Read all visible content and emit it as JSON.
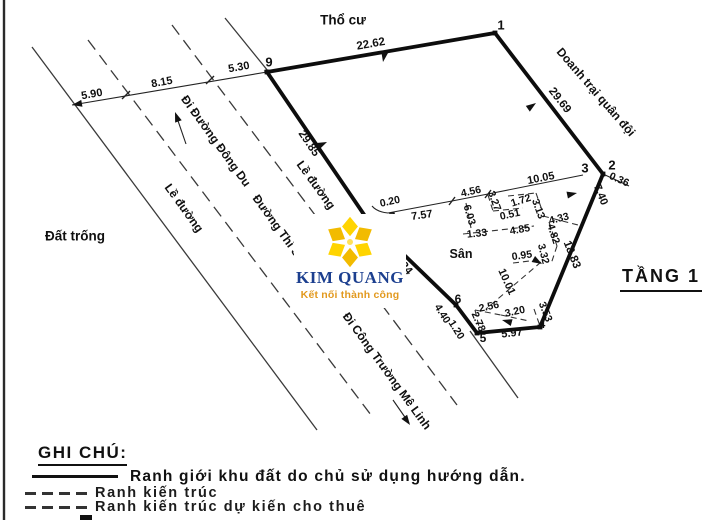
{
  "colors": {
    "ink": "#111111",
    "logo_navy": "#1c3f8f",
    "logo_orange": "#e2991e",
    "logo_yellow": "#ffd400",
    "logo_yellow_dark": "#f2bb00"
  },
  "logo": {
    "name": "KIM QUANG",
    "tagline": "Kết nối thành công"
  },
  "floor_tag": "TẦNG 1",
  "legend": {
    "title": "GHI CHÚ:",
    "items": [
      {
        "style": "solid-bold",
        "label": "Ranh giới khu đất do chủ sử dụng hướng dẫn."
      },
      {
        "style": "dashed",
        "label": "Ranh kiến trúc"
      },
      {
        "style": "dashed",
        "label": "Ranh kiến trúc dự kiến cho thuê"
      },
      {
        "style": "dashed-partial",
        "label": ""
      }
    ]
  },
  "diagram": {
    "boundary_points": "267,72 495,33 603,174 540,327 477,333 456,305 367,219",
    "lines": [
      {
        "name": "page-border-left",
        "cls": "border-line",
        "x1": 4,
        "y1": 0,
        "x2": 4,
        "y2": 520
      },
      {
        "name": "road-line-outer-left",
        "cls": "road-solid",
        "x1": 32,
        "y1": 47,
        "x2": 317,
        "y2": 430
      },
      {
        "name": "road-line-dash-left",
        "cls": "road-dash",
        "x1": 88,
        "y1": 40,
        "x2": 374,
        "y2": 419
      },
      {
        "name": "road-line-dash-right-upper",
        "cls": "road-dash",
        "x1": 172,
        "y1": 25,
        "x2": 315,
        "y2": 215
      },
      {
        "name": "road-line-dash-right-lower",
        "cls": "road-dash",
        "x1": 382,
        "y1": 305,
        "x2": 457,
        "y2": 405
      },
      {
        "name": "road-line-outer-right-upper",
        "cls": "road-solid",
        "x1": 225,
        "y1": 18,
        "x2": 268,
        "y2": 71
      },
      {
        "name": "road-line-outer-right-lower",
        "cls": "road-solid",
        "x1": 470,
        "y1": 331,
        "x2": 518,
        "y2": 398
      },
      {
        "name": "dim-line-left",
        "cls": "dim",
        "x1": 72,
        "y1": 105,
        "x2": 267,
        "y2": 72
      },
      {
        "name": "leader-0-36",
        "cls": "dim",
        "x1": 603,
        "y1": 174,
        "x2": 629,
        "y2": 186
      },
      {
        "name": "dir-dong-du-shaft",
        "cls": "dim",
        "x1": 186,
        "y1": 144,
        "x2": 176,
        "y2": 115
      },
      {
        "name": "dir-me-linh-shaft",
        "cls": "dim",
        "x1": 393,
        "y1": 400,
        "x2": 409,
        "y2": 423
      },
      {
        "name": "tick-dim-left-1",
        "cls": "tick",
        "x1": 122,
        "y1": 99,
        "x2": 130,
        "y2": 91
      },
      {
        "name": "tick-dim-left-2",
        "cls": "tick",
        "x1": 206,
        "y1": 84,
        "x2": 214,
        "y2": 76
      },
      {
        "name": "tick-dim-top-1",
        "cls": "tick",
        "x1": 449,
        "y1": 205,
        "x2": 455,
        "y2": 197
      },
      {
        "name": "tick-dim-top-2",
        "cls": "tick",
        "x1": 485,
        "y1": 198,
        "x2": 491,
        "y2": 190
      },
      {
        "name": "inner-wall-6-03",
        "cls": "inner-dash",
        "x1": 466,
        "y1": 203,
        "x2": 471,
        "y2": 228
      },
      {
        "name": "inner-wall-1-33",
        "cls": "inner-dash",
        "x1": 463,
        "y1": 234,
        "x2": 482,
        "y2": 232
      },
      {
        "name": "inner-wall-4-85",
        "cls": "inner-dash",
        "x1": 482,
        "y1": 232,
        "x2": 534,
        "y2": 226
      },
      {
        "name": "inner-wall-3-27",
        "cls": "inner-dash",
        "x1": 488,
        "y1": 195,
        "x2": 493,
        "y2": 211
      },
      {
        "name": "inner-wall-0-51",
        "cls": "inner-dash",
        "x1": 493,
        "y1": 211,
        "x2": 523,
        "y2": 208
      },
      {
        "name": "inner-wall-1-72",
        "cls": "inner-dash",
        "x1": 508,
        "y1": 196,
        "x2": 536,
        "y2": 193
      },
      {
        "name": "inner-wall-3-13",
        "cls": "inner-dash",
        "x1": 536,
        "y1": 193,
        "x2": 543,
        "y2": 213
      },
      {
        "name": "inner-wall-4-33",
        "cls": "inner-dash",
        "x1": 543,
        "y1": 216,
        "x2": 578,
        "y2": 225
      },
      {
        "name": "inner-wall-4-82",
        "cls": "inner-dash",
        "x1": 549,
        "y1": 222,
        "x2": 557,
        "y2": 246
      },
      {
        "name": "inner-wall-3-32",
        "cls": "inner-dash",
        "x1": 557,
        "y1": 246,
        "x2": 551,
        "y2": 264
      },
      {
        "name": "inner-wall-0-95",
        "cls": "inner-dash",
        "x1": 513,
        "y1": 263,
        "x2": 538,
        "y2": 260
      },
      {
        "name": "inner-wall-10-01",
        "cls": "inner-dash",
        "x1": 541,
        "y1": 262,
        "x2": 486,
        "y2": 309
      },
      {
        "name": "inner-wall-2-56",
        "cls": "inner-dash",
        "x1": 475,
        "y1": 310,
        "x2": 501,
        "y2": 315
      },
      {
        "name": "inner-wall-2-78",
        "cls": "inner-dash",
        "x1": 475,
        "y1": 310,
        "x2": 480,
        "y2": 331
      },
      {
        "name": "inner-wall-3-20",
        "cls": "inner-dash",
        "x1": 501,
        "y1": 315,
        "x2": 529,
        "y2": 321
      },
      {
        "name": "inner-wall-3-53",
        "cls": "inner-dash",
        "x1": 534,
        "y1": 309,
        "x2": 540,
        "y2": 326
      }
    ],
    "paths": [
      {
        "name": "dim-chain-top",
        "cls": "dim",
        "d": "M388,213 L452,201 L488,194 L583,175"
      },
      {
        "name": "leader-0-20-arc",
        "cls": "dim",
        "d": "M372,206 Q377,212 388,213"
      }
    ],
    "markers": [
      {
        "name": "corner-9",
        "x": 267,
        "y": 72
      },
      {
        "name": "corner-1",
        "x": 495,
        "y": 33
      },
      {
        "name": "corner-2",
        "x": 603,
        "y": 174
      },
      {
        "name": "corner-8",
        "x": 367,
        "y": 219
      },
      {
        "name": "corner-6",
        "x": 456,
        "y": 305
      },
      {
        "name": "corner-5",
        "x": 477,
        "y": 333
      },
      {
        "name": "corner-4",
        "x": 540,
        "y": 327
      }
    ],
    "arrows": [
      {
        "name": "arrow-22-62",
        "x": 383,
        "y": 62,
        "deg": 100
      },
      {
        "name": "arrow-29-69",
        "x": 536,
        "y": 103,
        "deg": -35
      },
      {
        "name": "arrow-29-85",
        "x": 327,
        "y": 142,
        "deg": -25
      },
      {
        "name": "arrow-10-05",
        "x": 577,
        "y": 193,
        "deg": -12
      },
      {
        "name": "arrow-0-95",
        "x": 542,
        "y": 264,
        "deg": 30
      },
      {
        "name": "arrow-3-20",
        "x": 502,
        "y": 320,
        "deg": 195
      },
      {
        "name": "arrow-dim-left-end",
        "x": 72,
        "y": 105,
        "deg": 170
      },
      {
        "name": "arrow-dir-dong-du",
        "x": 175,
        "y": 112,
        "deg": -110
      },
      {
        "name": "arrow-dir-me-linh",
        "x": 410,
        "y": 425,
        "deg": 55
      }
    ],
    "labels": [
      {
        "name": "area-label-tho-cu",
        "text": "Thổ cư",
        "x": 343,
        "y": 20,
        "deg": 0,
        "fs": 13.5
      },
      {
        "name": "area-label-dat-trong",
        "text": "Đất trống",
        "x": 75,
        "y": 236,
        "deg": 0,
        "fs": 13.5
      },
      {
        "name": "area-label-san",
        "text": "Sân",
        "x": 461,
        "y": 254,
        "deg": 0,
        "fs": 12.5
      },
      {
        "name": "street-label-le-duong-left",
        "text": "Lề đường",
        "x": 184,
        "y": 208,
        "deg": 54,
        "fs": 12
      },
      {
        "name": "street-label-di-duong-dong-du",
        "text": "Đi Đường Đông Du",
        "x": 216,
        "y": 141,
        "deg": 54,
        "fs": 12
      },
      {
        "name": "street-label-duong-thi-sach",
        "text": "Đường Thi Sách",
        "x": 283,
        "y": 234,
        "deg": 54,
        "fs": 12
      },
      {
        "name": "street-label-le-duong-right",
        "text": "Lề đường",
        "x": 316,
        "y": 185,
        "deg": 54,
        "fs": 12
      },
      {
        "name": "street-label-di-cong-truong-me-linh",
        "text": "Đi Công Trường Mê Linh",
        "x": 387,
        "y": 371,
        "deg": 54,
        "fs": 12
      },
      {
        "name": "area-label-doanh-trai-quan-doi",
        "text": "Doanh trại quân đội",
        "x": 596,
        "y": 92,
        "deg": 49,
        "fs": 12
      },
      {
        "name": "point-label-9",
        "text": "9",
        "x": 269,
        "y": 62,
        "deg": 0,
        "fs": 13
      },
      {
        "name": "point-label-1",
        "text": "1",
        "x": 501,
        "y": 25,
        "deg": 0,
        "fs": 13
      },
      {
        "name": "point-label-2",
        "text": "2",
        "x": 612,
        "y": 165,
        "deg": 0,
        "fs": 13
      },
      {
        "name": "point-label-3",
        "text": "3",
        "x": 585,
        "y": 168,
        "deg": 0,
        "fs": 13
      },
      {
        "name": "point-label-4",
        "text": "4",
        "x": 542,
        "y": 324,
        "deg": 0,
        "fs": 12
      },
      {
        "name": "point-label-5",
        "text": "5",
        "x": 483,
        "y": 338,
        "deg": 0,
        "fs": 12
      },
      {
        "name": "point-label-6",
        "text": "6",
        "x": 458,
        "y": 299,
        "deg": 0,
        "fs": 12
      },
      {
        "name": "point-label-7",
        "text": "7",
        "x": 392,
        "y": 217,
        "deg": 0,
        "fs": 12
      },
      {
        "name": "point-label-8",
        "text": "8",
        "x": 363,
        "y": 216,
        "deg": 0,
        "fs": 9
      },
      {
        "name": "dim-label-5-90",
        "text": "5.90",
        "x": 92,
        "y": 95,
        "deg": -10,
        "fs": 11
      },
      {
        "name": "dim-label-8-15",
        "text": "8.15",
        "x": 162,
        "y": 83,
        "deg": -10,
        "fs": 11
      },
      {
        "name": "dim-label-5-30",
        "text": "5.30",
        "x": 239,
        "y": 68,
        "deg": -10,
        "fs": 11
      },
      {
        "name": "dim-label-22-62",
        "text": "22.62",
        "x": 371,
        "y": 45,
        "deg": -10,
        "fs": 11.5
      },
      {
        "name": "dim-label-29-85",
        "text": "29.85",
        "x": 308,
        "y": 144,
        "deg": 56,
        "fs": 11.5
      },
      {
        "name": "dim-label-29-69",
        "text": "29.69",
        "x": 559,
        "y": 101,
        "deg": 52,
        "fs": 11.5
      },
      {
        "name": "dim-label-19-24",
        "text": "19.24",
        "x": 400,
        "y": 263,
        "deg": 49,
        "fs": 11.5
      },
      {
        "name": "dim-label-0-20",
        "text": "0.20",
        "x": 390,
        "y": 202,
        "deg": -12,
        "fs": 10.5
      },
      {
        "name": "dim-label-7-57",
        "text": "7.57",
        "x": 422,
        "y": 216,
        "deg": -8,
        "fs": 11
      },
      {
        "name": "dim-label-4-56",
        "text": "4.56",
        "x": 471,
        "y": 192,
        "deg": -12,
        "fs": 10.5
      },
      {
        "name": "dim-label-10-05",
        "text": "10.05",
        "x": 541,
        "y": 179,
        "deg": -11,
        "fs": 11
      },
      {
        "name": "dim-label-3-27",
        "text": "3.27",
        "x": 494,
        "y": 201,
        "deg": 70,
        "fs": 10.5
      },
      {
        "name": "dim-label-1-72",
        "text": "1.72",
        "x": 521,
        "y": 201,
        "deg": -18,
        "fs": 10.5
      },
      {
        "name": "dim-label-0-51",
        "text": "0.51",
        "x": 510,
        "y": 215,
        "deg": -12,
        "fs": 10.5
      },
      {
        "name": "dim-label-3-13",
        "text": "3.13",
        "x": 538,
        "y": 209,
        "deg": 70,
        "fs": 10.5
      },
      {
        "name": "dim-label-6-03",
        "text": "6.03",
        "x": 469,
        "y": 215,
        "deg": 74,
        "fs": 10.5
      },
      {
        "name": "dim-label-1-33",
        "text": "1.33",
        "x": 477,
        "y": 234,
        "deg": -6,
        "fs": 10.5
      },
      {
        "name": "dim-label-4-85",
        "text": "4.85",
        "x": 520,
        "y": 230,
        "deg": -10,
        "fs": 10.5
      },
      {
        "name": "dim-label-4-33",
        "text": "4.33",
        "x": 559,
        "y": 219,
        "deg": -14,
        "fs": 10.5
      },
      {
        "name": "dim-label-4-82",
        "text": "4.82",
        "x": 553,
        "y": 234,
        "deg": 72,
        "fs": 10.5
      },
      {
        "name": "dim-label-3-32",
        "text": "3.32",
        "x": 543,
        "y": 254,
        "deg": 76,
        "fs": 10.5
      },
      {
        "name": "dim-label-0-95",
        "text": "0.95",
        "x": 522,
        "y": 256,
        "deg": -8,
        "fs": 10.5
      },
      {
        "name": "dim-label-7-40",
        "text": "7.40",
        "x": 600,
        "y": 195,
        "deg": 68,
        "fs": 11
      },
      {
        "name": "dim-label-0-36",
        "text": "0.36",
        "x": 619,
        "y": 180,
        "deg": 24,
        "fs": 10.5
      },
      {
        "name": "dim-label-18-83",
        "text": "18.83",
        "x": 571,
        "y": 255,
        "deg": 68,
        "fs": 11.5
      },
      {
        "name": "dim-label-10-01",
        "text": "10.01",
        "x": 506,
        "y": 282,
        "deg": 66,
        "fs": 11
      },
      {
        "name": "dim-label-2-56",
        "text": "2.56",
        "x": 489,
        "y": 307,
        "deg": -12,
        "fs": 10.5
      },
      {
        "name": "dim-label-2-78",
        "text": "2.78",
        "x": 478,
        "y": 322,
        "deg": 66,
        "fs": 10.5
      },
      {
        "name": "dim-label-3-20",
        "text": "3.20",
        "x": 515,
        "y": 312,
        "deg": -12,
        "fs": 10.5
      },
      {
        "name": "dim-label-3-53",
        "text": "3.53",
        "x": 545,
        "y": 312,
        "deg": 68,
        "fs": 10.5
      },
      {
        "name": "dim-label-4-40",
        "text": "4.40",
        "x": 442,
        "y": 314,
        "deg": 58,
        "fs": 10.5
      },
      {
        "name": "dim-label-1-20",
        "text": "1.20",
        "x": 456,
        "y": 330,
        "deg": 58,
        "fs": 10.5
      },
      {
        "name": "dim-label-5-97",
        "text": "5.97",
        "x": 512,
        "y": 334,
        "deg": -6,
        "fs": 11
      }
    ]
  }
}
